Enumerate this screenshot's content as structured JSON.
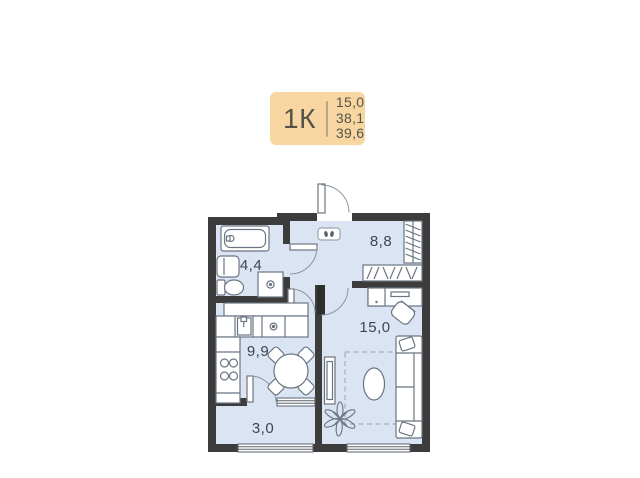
{
  "badge": {
    "type_label": "1К",
    "area_living": "15,0",
    "area_apartment": "38,1",
    "area_total": "39,6",
    "bg_color": "#f8d6a2",
    "text_color": "#55534a"
  },
  "floor_plan": {
    "rooms": {
      "bathroom": {
        "area": "4,4"
      },
      "hallway": {
        "area": "8,8"
      },
      "kitchen": {
        "area": "9,9"
      },
      "living_room": {
        "area": "15,0"
      },
      "balcony": {
        "area": "3,0"
      }
    },
    "furniture": [
      "bathtub",
      "sink",
      "toilet",
      "washing-machine",
      "kitchen-cabinets",
      "kitchen-sink",
      "cooktop",
      "dining-table",
      "chair",
      "wardrobe",
      "hanger-shelf",
      "electrical-panel",
      "desk",
      "desk-chair",
      "sofa",
      "rug",
      "coffee-table",
      "tv-console",
      "plant"
    ],
    "colors": {
      "room_fill": "#dbe4f3",
      "wall": "#3c3c3c",
      "furniture_stroke": "#6b7582",
      "door_arc": "#8b94a1",
      "label_text": "#3d4651"
    }
  }
}
